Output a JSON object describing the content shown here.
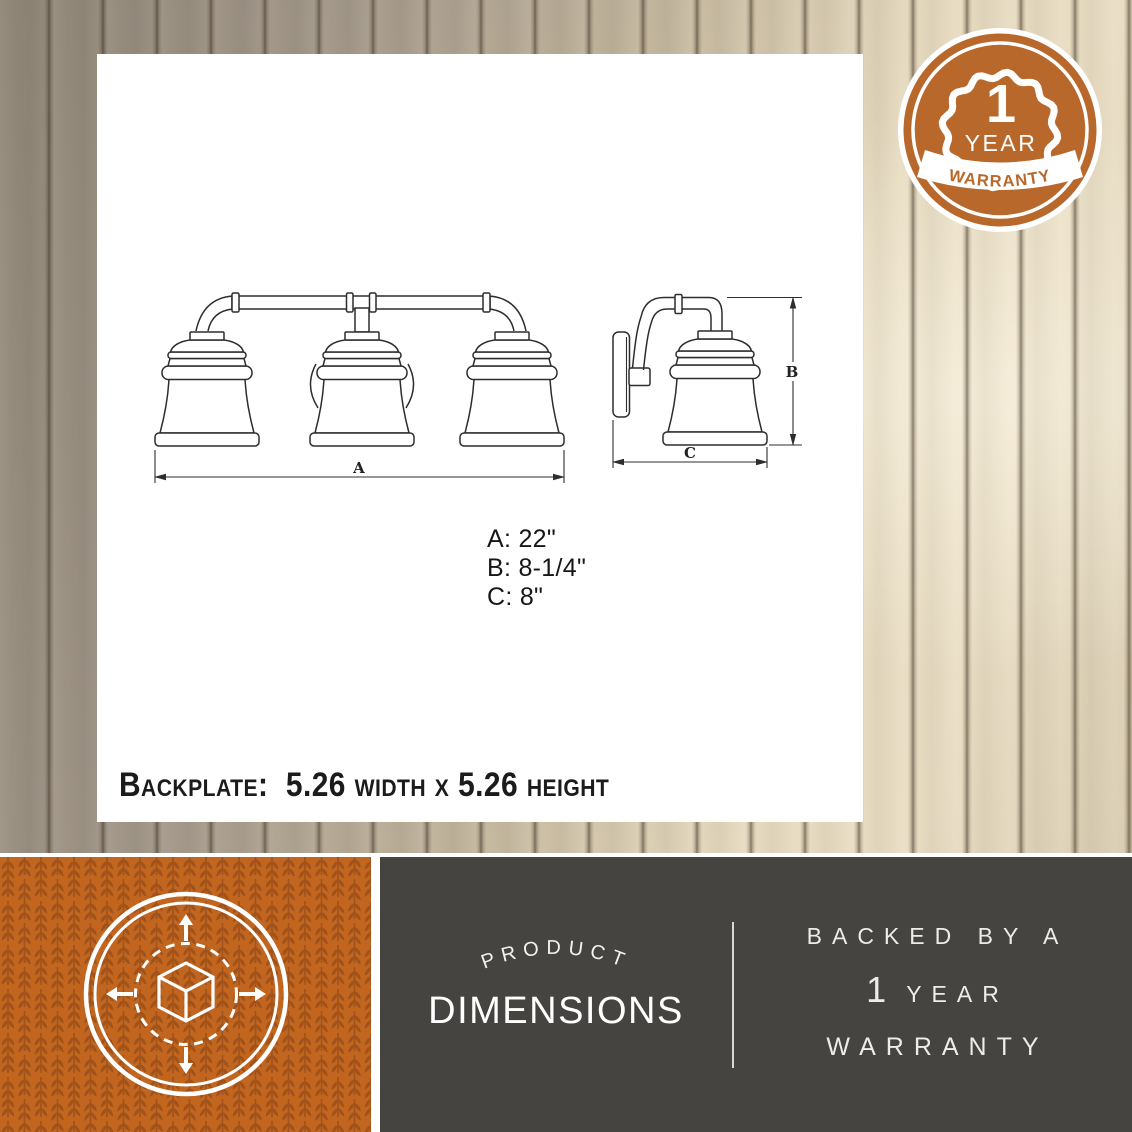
{
  "badge": {
    "number": "1",
    "year": "YEAR",
    "ribbon": "WARRANTY"
  },
  "drawing": {
    "labels": {
      "a": "A",
      "b": "B",
      "c": "C"
    },
    "dim_lines": [
      "A: 22\"",
      "B: 8-1/4\"",
      "C: 8\""
    ],
    "backplate_note": "Backplate:  5.26 width x 5.26 height"
  },
  "footer": {
    "arc_text": "PRODUCT",
    "title": "DIMENSIONS",
    "warranty_line1": "BACKED BY A",
    "warranty_number": "1",
    "warranty_year": "YEAR",
    "warranty_word": "WARRANTY"
  },
  "icons": {
    "badge_icon": "warranty-seal-ribbon",
    "footer_left_icon": "cube-expand-arrows"
  },
  "colors": {
    "accent_orange": "#c2661f",
    "pattern_orange": "#a0521a",
    "badge_orange": "#b9682c",
    "panel_gray": "#464441",
    "wood_dark": "#8e8476",
    "wood_light": "#e9ddc3",
    "drawing_line": "#2d2d2d"
  }
}
